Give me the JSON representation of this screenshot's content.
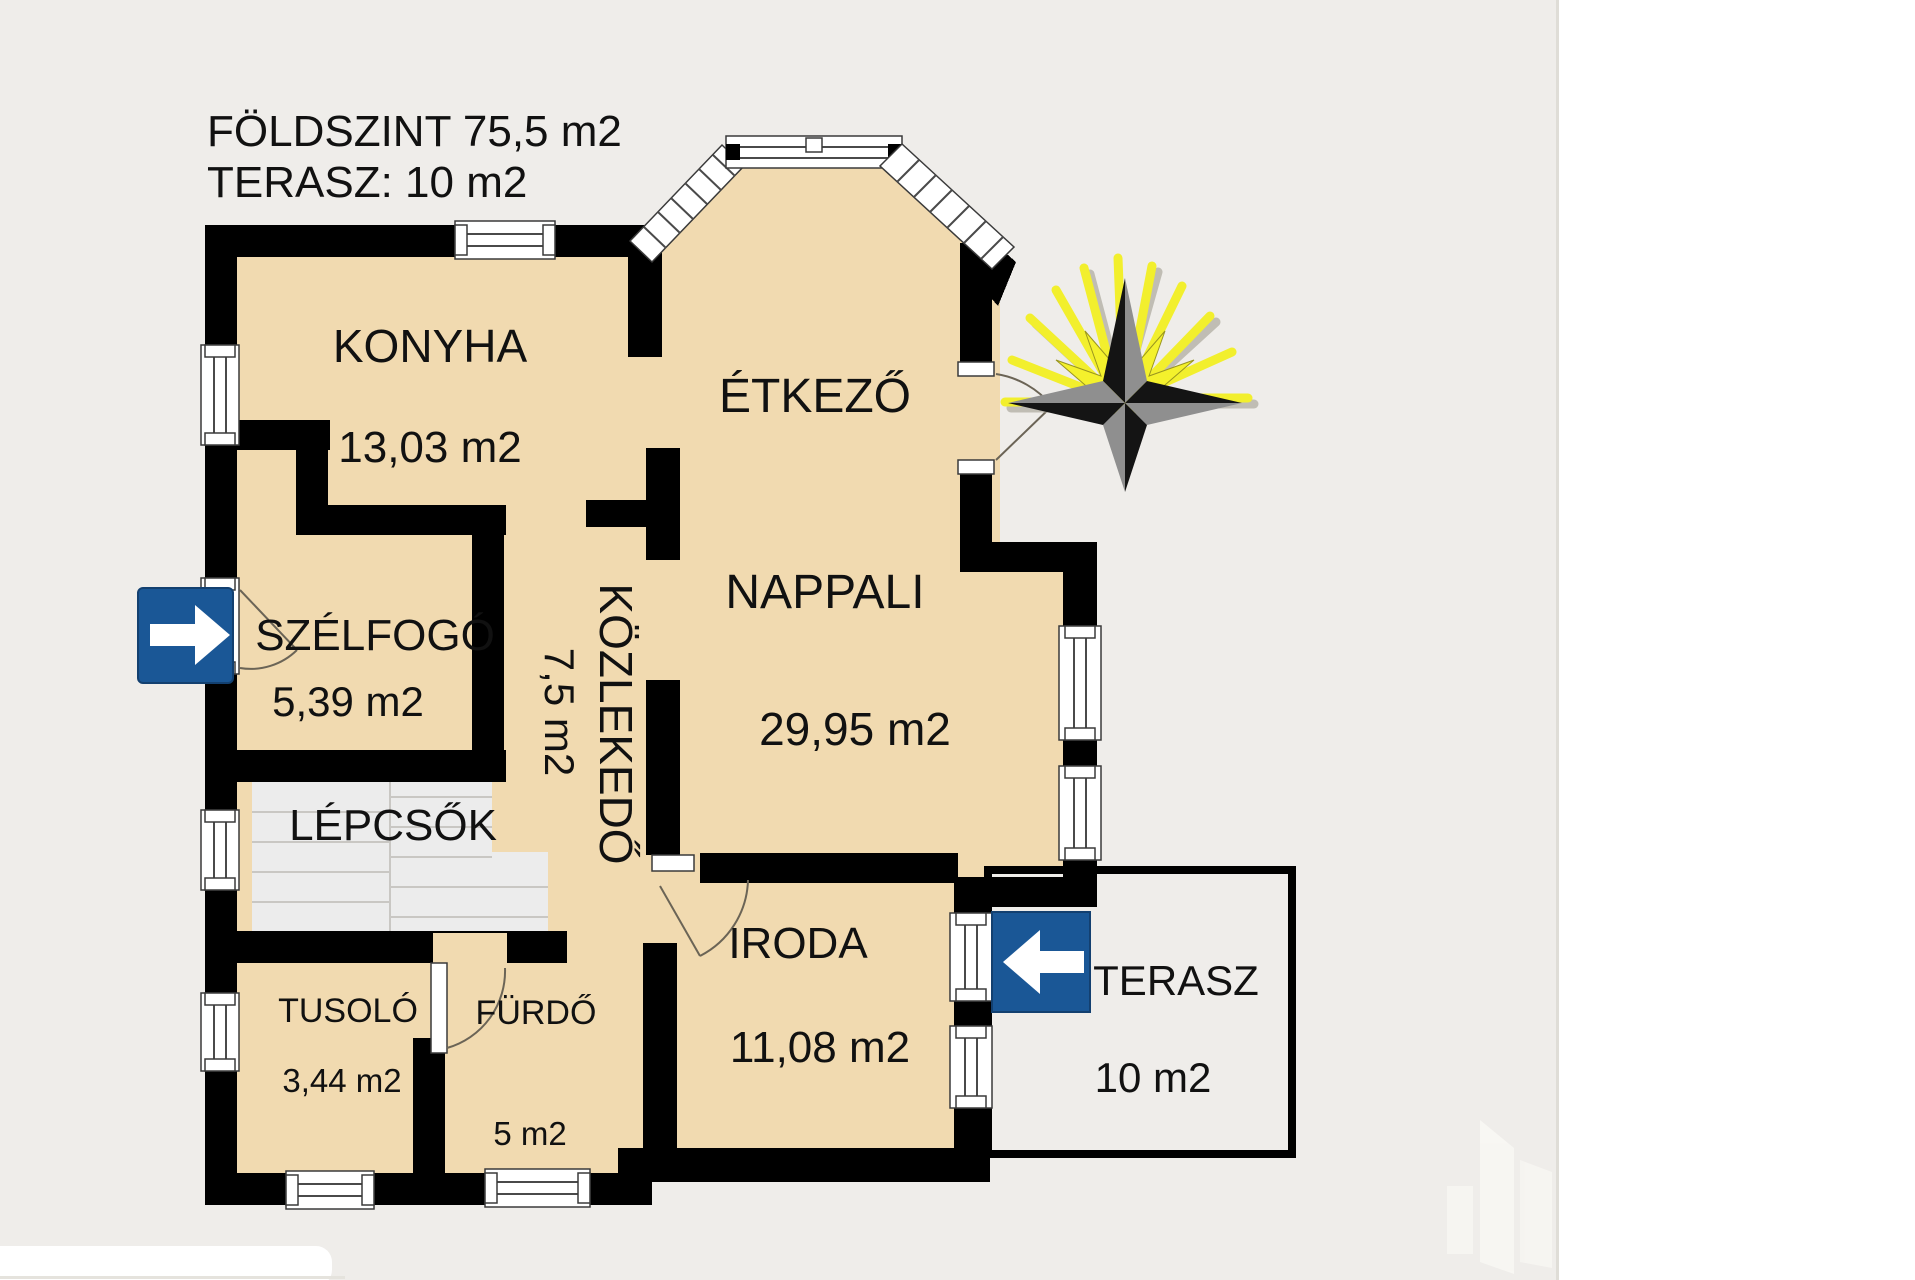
{
  "title": {
    "line1": "FÖLDSZINT 75,5 m2",
    "line2": "TERASZ: 10 m2"
  },
  "rooms": {
    "konyha": {
      "name": "KONYHA",
      "area": "13,03 m2"
    },
    "etkezo": {
      "name": "ÉTKEZŐ"
    },
    "nappali": {
      "name": "NAPPALI",
      "area": "29,95 m2"
    },
    "szelfogo": {
      "name": "SZÉLFOGÓ",
      "area": "5,39 m2"
    },
    "kozlekedo": {
      "name": "KÖZLEKEDŐ",
      "area": "7,5 m2"
    },
    "lepcsok": {
      "name": "LÉPCSŐK"
    },
    "tusolo": {
      "name": "TUSOLÓ",
      "area": "3,44 m2"
    },
    "furdo": {
      "name": "FÜRDŐ",
      "area": "5 m2"
    },
    "iroda": {
      "name": "IRODA",
      "area": "11,08 m2"
    },
    "terasz": {
      "name": "TERASZ",
      "area": "10 m2"
    }
  },
  "icons": {
    "entrance_arrow": "arrow-right",
    "terrace_arrow": "arrow-left",
    "compass": "compass-star-with-sun-rays",
    "watermark": "building-logo"
  },
  "colors": {
    "floor": "#f1dab0",
    "wall": "#000000",
    "background": "#efedea",
    "arrow_blue": "#1a5796",
    "stairs": "#ececec",
    "compass_ray": "#f2ef2d"
  }
}
